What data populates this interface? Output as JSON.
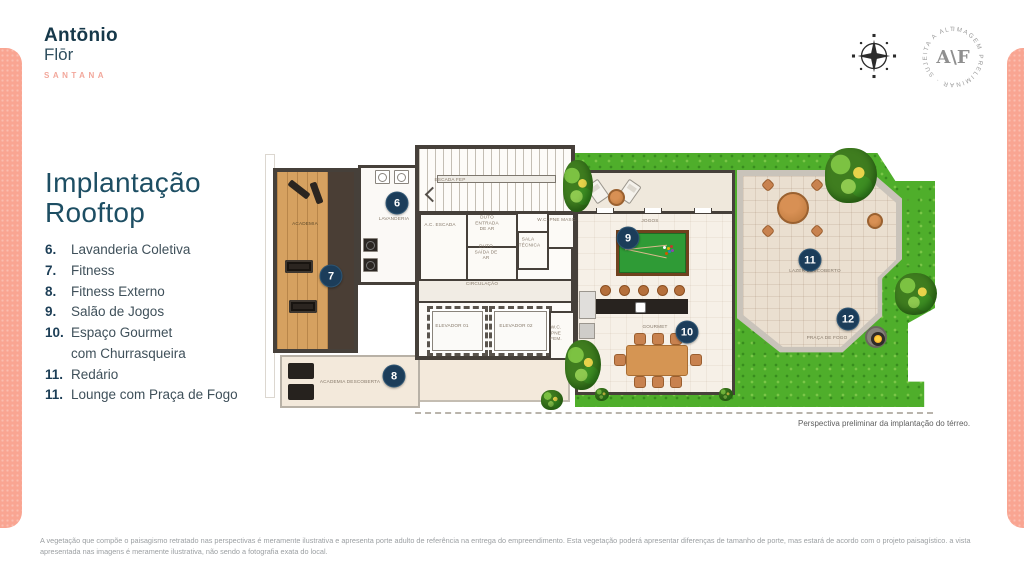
{
  "brand": {
    "line1": "Antōnio",
    "line2": "Flōr",
    "subtitle": "SANTANA"
  },
  "stamp": {
    "ring": "IMAGEM PRELIMINAR · SUJEITA A ALTERAÇÃO ·",
    "center": "A\\F"
  },
  "page_title": {
    "line1": "Implantação",
    "line2": "Rooftop"
  },
  "legend": [
    {
      "num": "6.",
      "label": "Lavanderia Coletiva"
    },
    {
      "num": "7.",
      "label": "Fitness"
    },
    {
      "num": "8.",
      "label": "Fitness Externo"
    },
    {
      "num": "9.",
      "label": "Salão de Jogos"
    },
    {
      "num": "10.",
      "label": "Espaço Gourmet",
      "label2": "com Churrasqueira"
    },
    {
      "num": "11.",
      "label": "Redário"
    },
    {
      "num": "11.",
      "label": "Lounge com Praça de Fogo"
    }
  ],
  "plan": {
    "labels": {
      "academia": "ACADEMIA",
      "lavanderia": "LAVANDERIA",
      "escada": "ESCADA FEP",
      "ac_escada": "A.C. ESCADA",
      "duto_entrada": "DUTO ENTRADA DE AR",
      "duto_saida": "DUTO SAÍDA DE AR",
      "sala_tecnica": "SALA TÉCNICA",
      "wc_masc": "W.C. PNE MASC.",
      "circulacao": "CIRCULAÇÃO",
      "elevador1": "ELEVADOR 01",
      "elevador2": "ELEVADOR 02",
      "wc_fem": "W.C. PNE FEM.",
      "academia_descoberta": "ACADEMIA DESCOBERTA",
      "jogos": "JOGOS",
      "gourmet": "GOURMET",
      "lazer": "LAZER DESCOBERTO",
      "praca_fogo": "PRAÇA DE FOGO"
    },
    "markers": {
      "m6": "6",
      "m7": "7",
      "m8": "8",
      "m9": "9",
      "m10": "10",
      "m11": "11",
      "m12": "12"
    }
  },
  "caption": "Perspectiva preliminar da implantação do térreo.",
  "disclaimer": "A vegetação que compõe o paisagismo retratado nas perspectivas é meramente ilustrativa e apresenta porte adulto de referência na entrega do empreendimento. Esta vegetação poderá apresentar diferenças de tamanho de porte, mas estará de acordo com o projeto paisagístico. a vista apresentada nas imagens é meramente ilustrativa, não sendo a fotografia exata do local.",
  "colors": {
    "accent_pink": "#F9A592",
    "navy": "#1C3D5A",
    "title_teal": "#1D4E63",
    "grass_green": "#4FAE2B",
    "wood": "#D6A160"
  }
}
